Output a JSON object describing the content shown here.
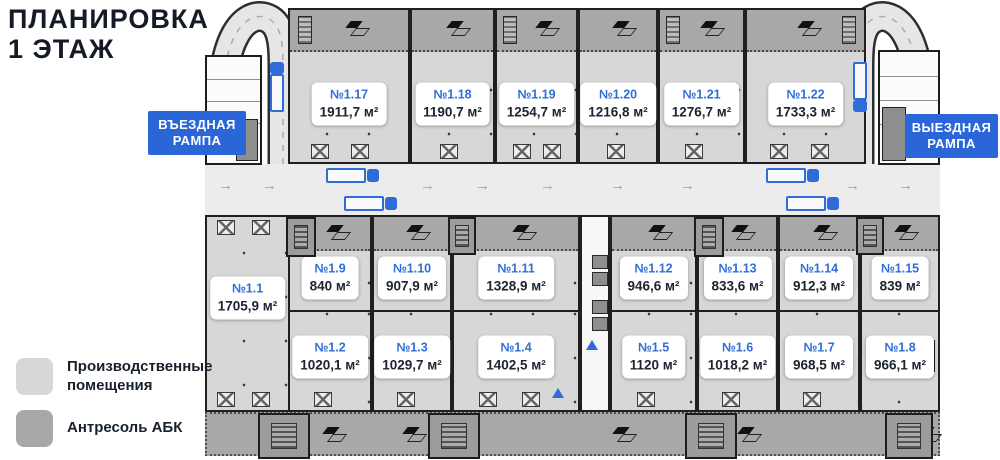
{
  "title": {
    "line1": "ПЛАНИРОВКА",
    "line2": "1 ЭТАЖ"
  },
  "ramps": {
    "entry_label": "ВЪЕЗДНАЯ РАМПА",
    "exit_label": "ВЫЕЗДНАЯ РАМПА"
  },
  "legend": {
    "production": {
      "label": "Производственные помещения",
      "color": "#d7d7d7"
    },
    "mezzanine": {
      "label": "Антресоль АБК",
      "color": "#a8a8a8"
    }
  },
  "colors": {
    "accent_blue": "#2b66d9",
    "unit_number_blue": "#2f6fd6",
    "production_fill": "#d7d7d7",
    "mezzanine_fill": "#a8a8a8",
    "wall": "#1f1f1f"
  },
  "units": {
    "u1_1": {
      "num": "№1.1",
      "area": "1705,9 м²"
    },
    "u1_2": {
      "num": "№1.2",
      "area": "1020,1 м²"
    },
    "u1_3": {
      "num": "№1.3",
      "area": "1029,7 м²"
    },
    "u1_4": {
      "num": "№1.4",
      "area": "1402,5 м²"
    },
    "u1_5": {
      "num": "№1.5",
      "area": "1120 м²"
    },
    "u1_6": {
      "num": "№1.6",
      "area": "1018,2 м²"
    },
    "u1_7": {
      "num": "№1.7",
      "area": "968,5 м²"
    },
    "u1_8": {
      "num": "№1.8",
      "area": "966,1 м²"
    },
    "u1_9": {
      "num": "№1.9",
      "area": "840 м²"
    },
    "u1_10": {
      "num": "№1.10",
      "area": "907,9 м²"
    },
    "u1_11": {
      "num": "№1.11",
      "area": "1328,9 м²"
    },
    "u1_12": {
      "num": "№1.12",
      "area": "946,6 м²"
    },
    "u1_13": {
      "num": "№1.13",
      "area": "833,6 м²"
    },
    "u1_14": {
      "num": "№1.14",
      "area": "912,3 м²"
    },
    "u1_15": {
      "num": "№1.15",
      "area": "839 м²"
    },
    "u1_17": {
      "num": "№1.17",
      "area": "1911,7 м²"
    },
    "u1_18": {
      "num": "№1.18",
      "area": "1190,7 м²"
    },
    "u1_19": {
      "num": "№1.19",
      "area": "1254,7 м²"
    },
    "u1_20": {
      "num": "№1.20",
      "area": "1216,8 м²"
    },
    "u1_21": {
      "num": "№1.21",
      "area": "1276,7 м²"
    },
    "u1_22": {
      "num": "№1.22",
      "area": "1733,3 м²"
    }
  }
}
